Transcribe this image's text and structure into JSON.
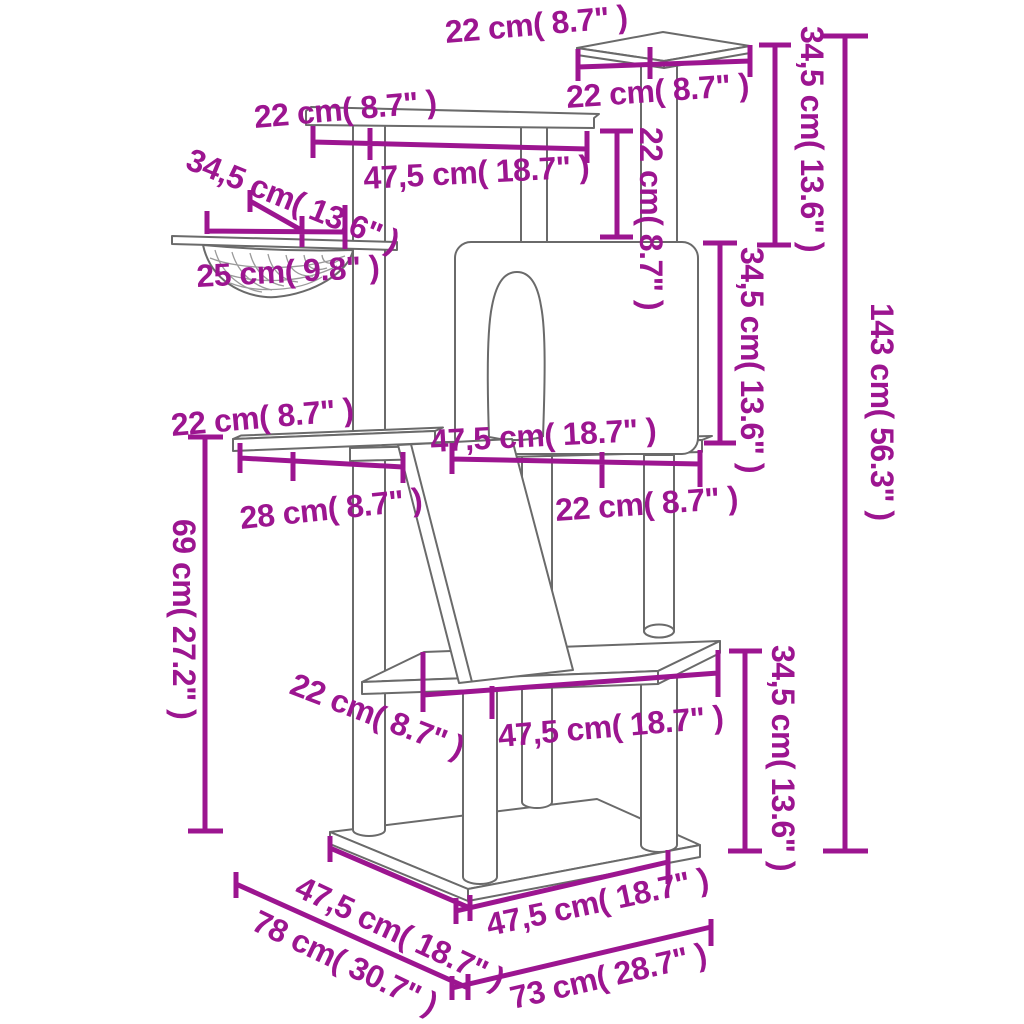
{
  "diagram": {
    "figure_type": "product-dimension-diagram",
    "subject": "cat-tree-with-scratching-posts",
    "colors": {
      "dimension_accent": "#9C1590",
      "outline_gray": "#6a6a6a",
      "background": "#ffffff"
    },
    "labels": {
      "top_platform_depth": "22 cm( 8.7\" )",
      "top_platform_width": "22 cm( 8.7\" )",
      "top_right_height": "34,5 cm( 13.6\" )",
      "total_height": "143 cm( 56.3\" )",
      "upper_platform_depth": "22 cm( 8.7\" )",
      "upper_platform_width": "47,5 cm( 18.7\" )",
      "hammock_width": "34,5 cm( 13.6\" )",
      "hammock_inner": "25 cm( 9.8\" )",
      "post_gap_height": "22 cm( 8.7\" )",
      "condo_height": "34,5 cm( 13.6\" )",
      "mid_shelf_depth": "22 cm( 8.7\" )",
      "mid_shelf_width": "28 cm( 8.7\" )",
      "mid_platform_width": "47,5 cm( 18.7\" )",
      "mid_platform_right": "22 cm( 8.7\" )",
      "mid_height": "69 cm( 27.2\" )",
      "lower_platform_depth": "22 cm( 8.7\" )",
      "lower_platform_width": "47,5 cm( 18.7\" )",
      "lower_height": "34,5 cm( 13.6\" )",
      "base_depth": "47,5 cm( 18.7\" )",
      "base_depth_total": "78 cm( 30.7\" )",
      "base_width": "47,5 cm( 18.7\" )",
      "base_width_total": "73 cm( 28.7\" )"
    }
  }
}
